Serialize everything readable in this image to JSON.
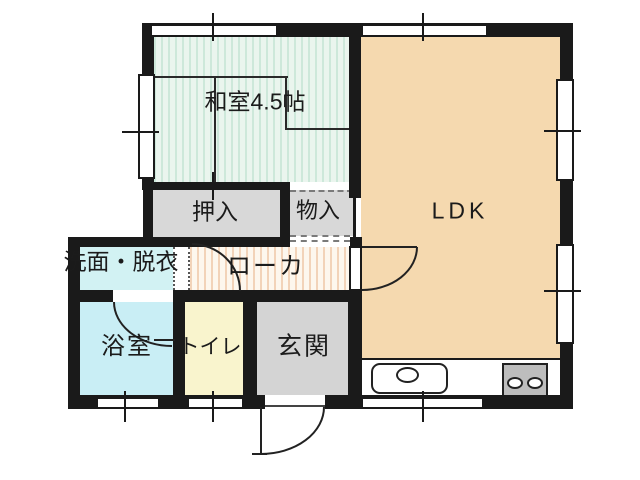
{
  "floorplan": {
    "type": "apartment-floor-plan",
    "rooms": {
      "washitsu": {
        "label": "和室4.5帖",
        "fill": "#eaf5ee"
      },
      "oshiire": {
        "label": "押入",
        "fill": "#d8d8d8"
      },
      "monoire": {
        "label": "物入",
        "fill": "#d8d8d8"
      },
      "ldk": {
        "label": "LDK",
        "fill": "#f5d9af"
      },
      "senmen": {
        "label": "洗面・脱衣",
        "fill": "#d2f2f3"
      },
      "roka": {
        "label": "ローカ",
        "fill": "#fdf7ee"
      },
      "yokushitsu": {
        "label": "浴室",
        "fill": "#c9eef5"
      },
      "toire": {
        "label": "トイレ",
        "fill": "#f9f4cd"
      },
      "genkan": {
        "label": "玄関",
        "fill": "#d4d4d4"
      }
    },
    "colors": {
      "wall": "#1a1a1a",
      "tatami_stripe": "#cde8da",
      "corridor_stripe": "#f2d3b9",
      "stove": "#bdbdbd"
    },
    "fixtures": {
      "sink": "kitchen-sink",
      "stove": "two-burner-stove"
    }
  }
}
